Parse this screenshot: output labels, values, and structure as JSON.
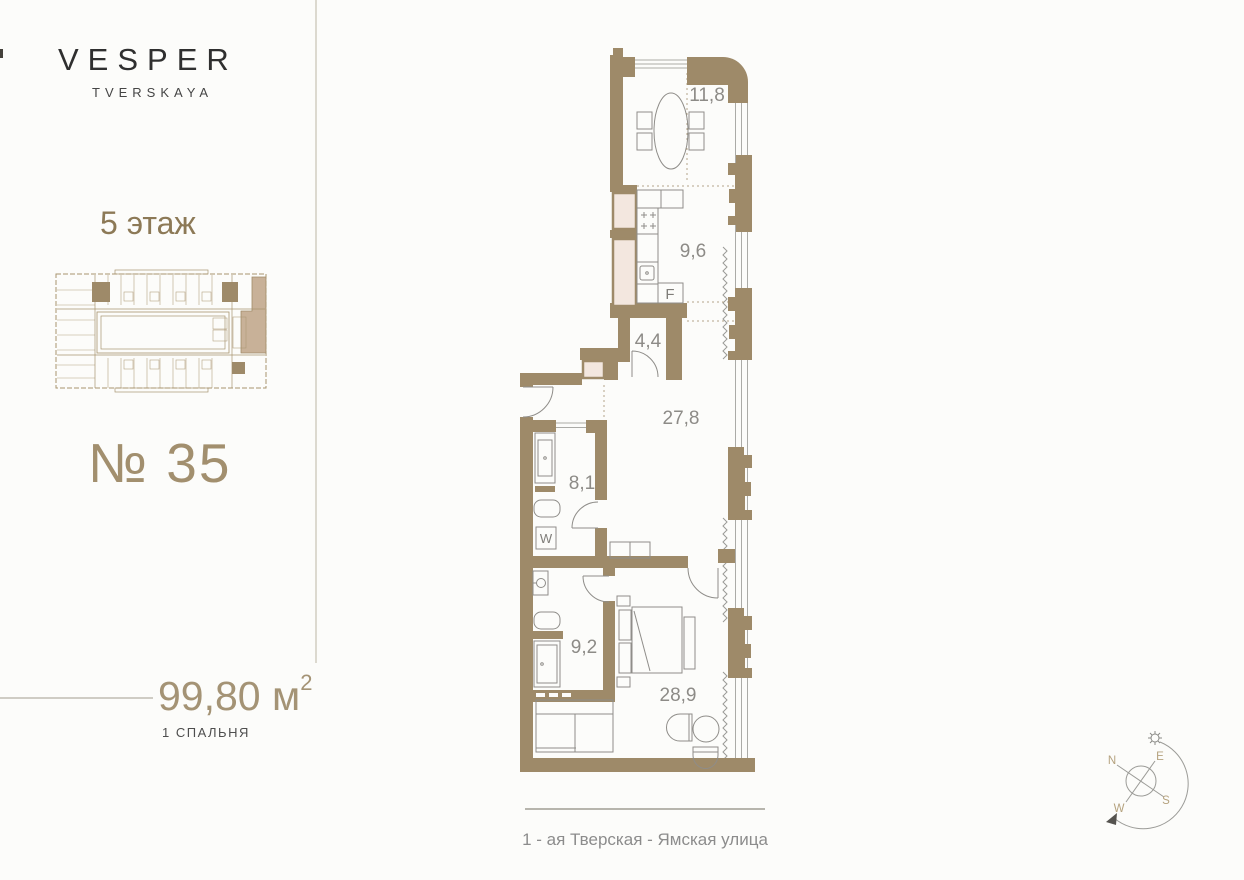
{
  "brand": {
    "name": "VESPER",
    "subname": "TVERSKAYA"
  },
  "floor": {
    "label": "5 этаж"
  },
  "unit": {
    "number": "№ 35",
    "area_value": "99,80",
    "area_unit": "м",
    "area_sup": "2",
    "bedrooms_label": "1 СПАЛЬНЯ"
  },
  "street": {
    "label": "1 - ая Тверская - Ямская улица"
  },
  "plan": {
    "rooms": [
      {
        "name": "dining-room",
        "area": "11,8"
      },
      {
        "name": "kitchen",
        "area": "9,6"
      },
      {
        "name": "hallway",
        "area": "4,4"
      },
      {
        "name": "living-room",
        "area": "27,8"
      },
      {
        "name": "bathroom-1",
        "area": "8,1"
      },
      {
        "name": "bathroom-2",
        "area": "9,2"
      },
      {
        "name": "bedroom",
        "area": "28,9"
      }
    ],
    "appliance_marks": {
      "fridge": "F",
      "washer": "W"
    }
  },
  "compass": {
    "n": "N",
    "e": "E",
    "s": "S",
    "w": "W"
  },
  "colors": {
    "wall": "#9e8a69",
    "shaft_fill": "#f3e7df",
    "unit_highlight": "#c8b198",
    "accent_text": "#a28f6e",
    "floor_text": "#8c7956",
    "room_label": "#8d8b87",
    "divider": "#dcd9cf"
  }
}
